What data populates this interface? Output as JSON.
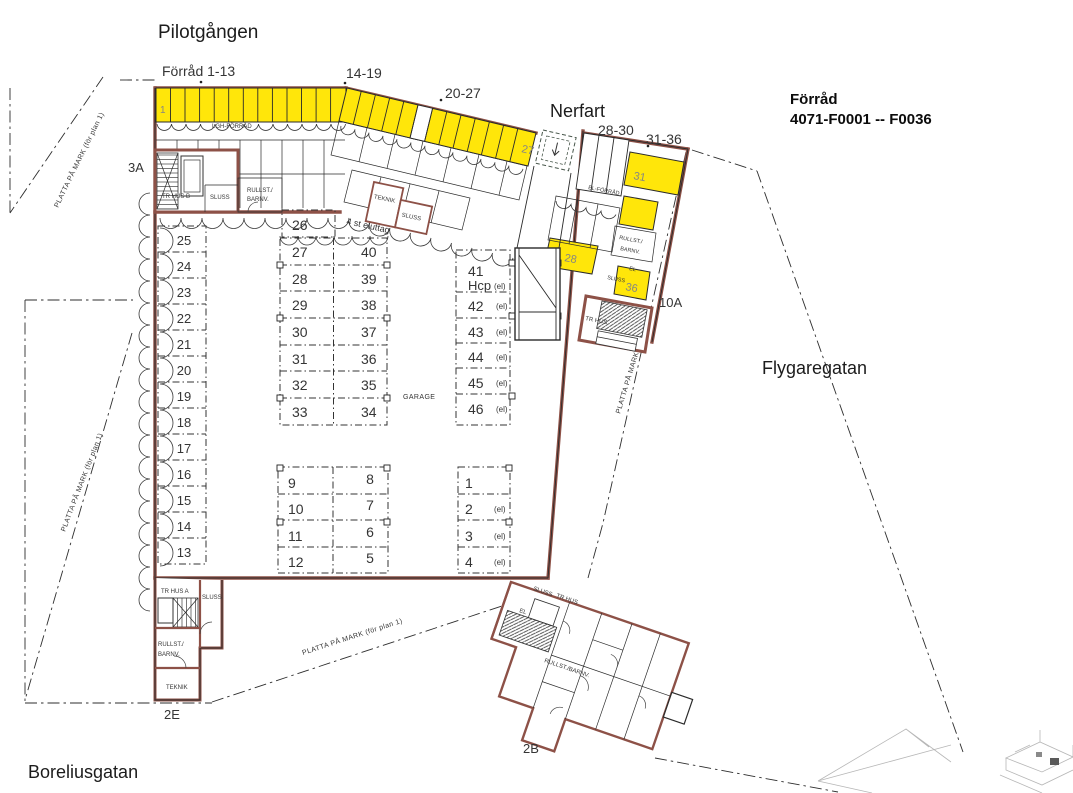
{
  "colors": {
    "highlight_yellow": "#ffe60a",
    "wall_brown": "#8d5147",
    "ink": "#2b2b2b"
  },
  "streets": {
    "top": "Pilotgången",
    "nerfart": "Nerfart",
    "right": "Flygaregatan",
    "bottom": "Boreliusgatan"
  },
  "header": {
    "line1": "Förråd",
    "line2": "4071-F0001 -- F0036"
  },
  "ranges": {
    "r1_13": "Förråd 1-13",
    "r14_19": "14-19",
    "r20_27": "20-27",
    "r28_30": "28-30",
    "r31_36": "31-36"
  },
  "entrances": {
    "e3a": "3A",
    "e10a": "10A",
    "e2e": "2E",
    "e2b": "2B"
  },
  "ground_note": "PLATTA PÅ MARK (för plan 1)",
  "notes": {
    "garage": "GARAGE",
    "outlets": "4 st eluttag",
    "lgh_forrad": "LGH-FÖRRÅD"
  },
  "rooms": {
    "tr_hus_b": "TR HUS B",
    "tr_hus_a": "TR HUS A",
    "tr_hus": "TR HUS",
    "sluss": "SLUSS",
    "rullst": "RULLST./",
    "barnv": "BARNV.",
    "rullst_barnv": "RULLST./BARNV.",
    "teknik": "TEKNIK",
    "el": "EL",
    "el_forrad": "EL-FÖRRÅD"
  },
  "stalls": {
    "left": [
      "25",
      "24",
      "23",
      "22",
      "21",
      "20",
      "19",
      "18",
      "17",
      "16",
      "15",
      "14",
      "13"
    ],
    "mid_top": "26",
    "mid_left": [
      "27",
      "28",
      "29",
      "30",
      "31",
      "32",
      "33"
    ],
    "mid_right": [
      "40",
      "39",
      "38",
      "37",
      "36",
      "35",
      "34"
    ],
    "right": [
      "41",
      "42",
      "43",
      "44",
      "45",
      "46"
    ],
    "hcp": "Hcp",
    "el_mark": "(el)",
    "low_left": [
      "9",
      "10",
      "11",
      "12"
    ],
    "low_right": [
      "8",
      "7",
      "6",
      "5"
    ],
    "low_el": [
      "1",
      "2",
      "3",
      "4"
    ]
  },
  "yellow_units": {
    "u1": "1",
    "u27": "27",
    "u31": "31",
    "u28": "28",
    "u36": "36"
  }
}
